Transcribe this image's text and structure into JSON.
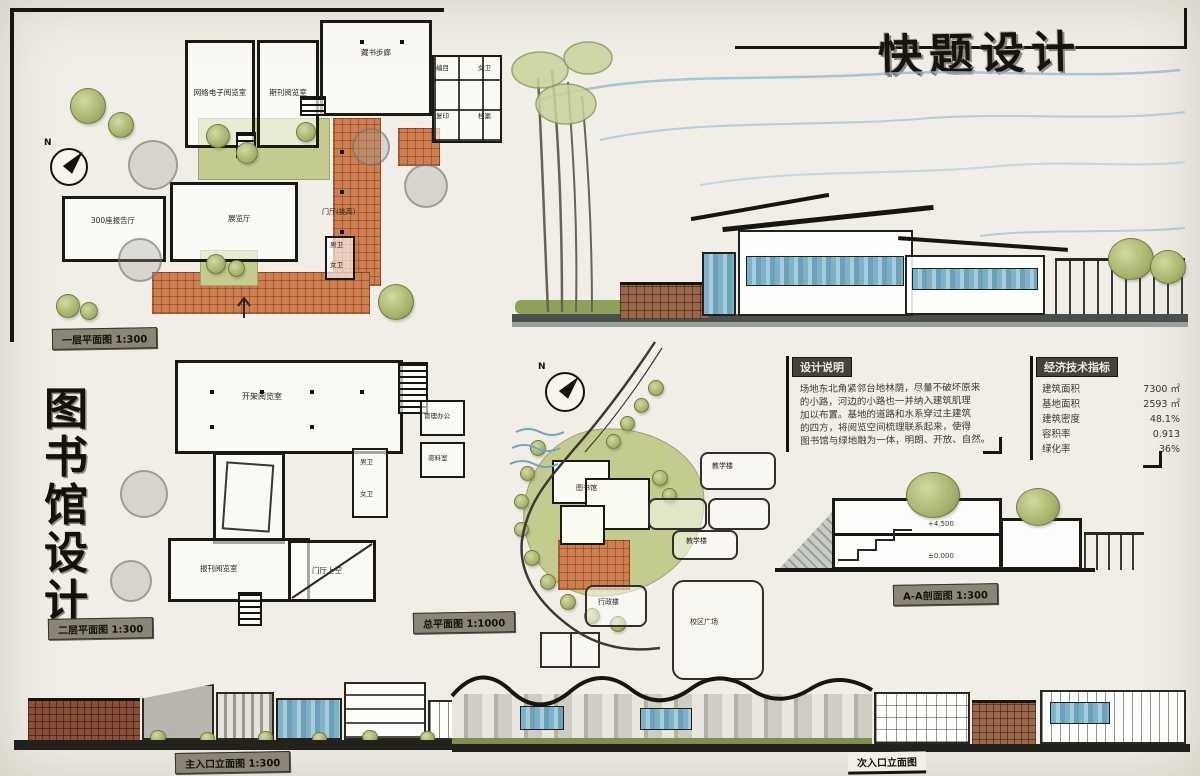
{
  "board": {
    "main_title": "快题设计",
    "side_title_chars": [
      "图",
      "书",
      "馆",
      "设",
      "计"
    ]
  },
  "captions": {
    "floor1": "一层平面图 1:300",
    "floor2": "二层平面图 1:300",
    "site": "总平面图 1:1000",
    "section": "A-A剖面图 1:300",
    "elev_main": "主入口立面图 1:300",
    "elev_secondary": "次入口立面图"
  },
  "floor1": {
    "compass": "N",
    "rooms": {
      "reading_net": "网络电子阅览室",
      "reading_periodical": "期刊阅览室",
      "stack_gallery": "藏书步廊",
      "lecture_hall": "300座报告厅",
      "exhibition": "展览厅",
      "lobby": "门厅(挑高)",
      "wc_m": "男卫",
      "wc_f": "女卫",
      "office_catalog": "编目",
      "office_copy": "复印",
      "office_archive": "档案",
      "office_store": "贮藏"
    }
  },
  "floor2": {
    "rooms": {
      "open_reading": "开架阅览室",
      "press_reading": "报刊阅览室",
      "lobby_void": "门厅上空",
      "admin_office": "管理办公",
      "archive_room": "资料室",
      "wc_m": "男卫",
      "wc_f": "女卫"
    }
  },
  "site": {
    "compass": "N",
    "labels": {
      "library": "图书馆",
      "teaching1": "教学楼",
      "teaching2": "教学楼",
      "admin": "行政楼",
      "plaza": "校区广场"
    }
  },
  "notes": {
    "title": "设计说明",
    "lines": [
      "场地东北角紧邻台地林荫，尽量不破坏原来",
      "的小路，河边的小路也一并纳入建筑肌理",
      "加以布置。基地的道路和水系穿过主建筑",
      "的四方，将阅览空间梳理联系起来，使得",
      "图书馆与绿地融为一体，明朗、开放、自然。"
    ]
  },
  "indicators": {
    "title": "经济技术指标",
    "rows": [
      {
        "label": "建筑面积",
        "value": "7300 ㎡"
      },
      {
        "label": "基地面积",
        "value": "2593 ㎡"
      },
      {
        "label": "建筑密度",
        "value": "48.1%"
      },
      {
        "label": "容积率",
        "value": "0.913"
      },
      {
        "label": "绿化率",
        "value": "36%"
      }
    ]
  },
  "section": {
    "levels": [
      "+4.500",
      "±0.000"
    ]
  }
}
